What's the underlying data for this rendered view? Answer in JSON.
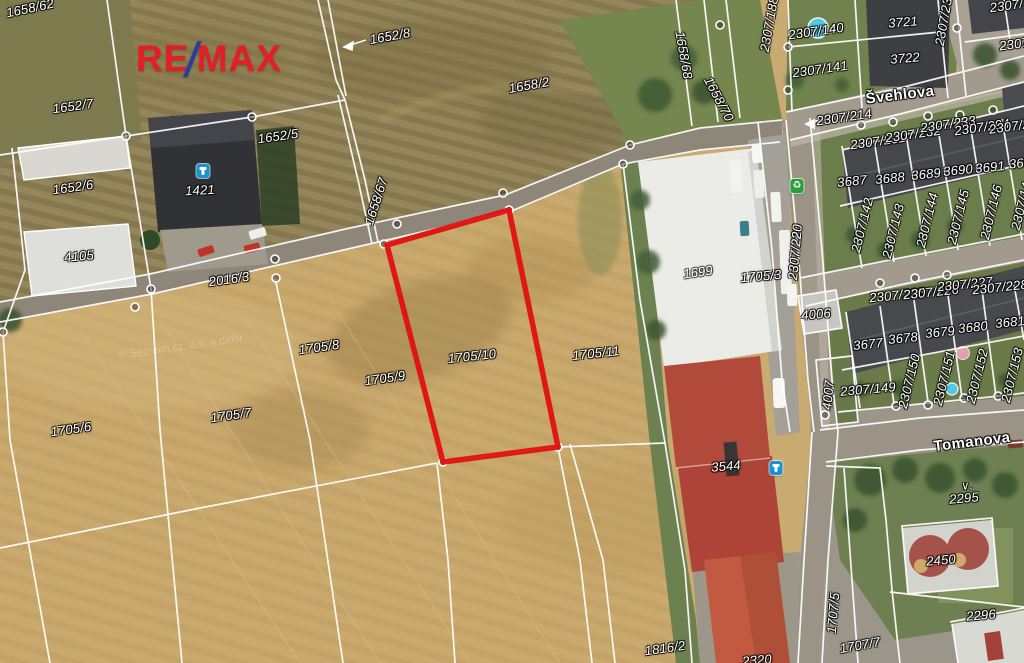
{
  "branding": {
    "re": "RE",
    "slash": "/",
    "max": "MAX"
  },
  "watermark": "© Seznam.cz, a.s. a další",
  "highlighted_parcel": {
    "id": "1705/10",
    "outline_color": "#e11212",
    "points": "387,245 509,210 558,447 443,462"
  },
  "streets": [
    {
      "name": "Švehlova"
    },
    {
      "name": "Tomanova"
    }
  ],
  "labels": [
    {
      "text": "1658/62",
      "x": 30,
      "y": 8,
      "rot": -12,
      "kind": "parcel"
    },
    {
      "text": "1652/8",
      "x": 390,
      "y": 36,
      "rot": -10,
      "kind": "parcel"
    },
    {
      "text": "1658/2",
      "x": 529,
      "y": 85,
      "rot": -10,
      "kind": "parcel"
    },
    {
      "text": "1652/7",
      "x": 73,
      "y": 106,
      "rot": -8,
      "kind": "parcel"
    },
    {
      "text": "1652/5",
      "x": 278,
      "y": 136,
      "rot": -8,
      "kind": "parcel"
    },
    {
      "text": "1652/6",
      "x": 73,
      "y": 187,
      "rot": -8,
      "kind": "parcel"
    },
    {
      "text": "1421",
      "x": 200,
      "y": 190,
      "rot": -3,
      "kind": "building"
    },
    {
      "text": "4105",
      "x": 79,
      "y": 256,
      "rot": -5,
      "kind": "building"
    },
    {
      "text": "2016/3",
      "x": 229,
      "y": 279,
      "rot": -8,
      "kind": "parcel"
    },
    {
      "text": "1705/8",
      "x": 319,
      "y": 347,
      "rot": -8,
      "kind": "parcel"
    },
    {
      "text": "1705/9",
      "x": 385,
      "y": 378,
      "rot": -8,
      "kind": "parcel"
    },
    {
      "text": "1705/10",
      "x": 472,
      "y": 356,
      "rot": -6,
      "kind": "parcel"
    },
    {
      "text": "1705/11",
      "x": 596,
      "y": 353,
      "rot": -6,
      "kind": "parcel"
    },
    {
      "text": "1705/7",
      "x": 231,
      "y": 415,
      "rot": -8,
      "kind": "parcel"
    },
    {
      "text": "1705/6",
      "x": 71,
      "y": 429,
      "rot": -8,
      "kind": "parcel"
    },
    {
      "text": "1699",
      "x": 698,
      "y": 272,
      "rot": -8,
      "kind": "faint"
    },
    {
      "text": "1705/3",
      "x": 761,
      "y": 276,
      "rot": -5,
      "kind": "parcel"
    },
    {
      "text": "4006",
      "x": 816,
      "y": 314,
      "rot": -5,
      "kind": "building"
    },
    {
      "text": "3544",
      "x": 726,
      "y": 466,
      "rot": -5,
      "kind": "building"
    },
    {
      "text": "Tomanova",
      "x": 972,
      "y": 442,
      "rot": -7,
      "kind": "street"
    },
    {
      "text": "2295",
      "x": 964,
      "y": 498,
      "rot": -5,
      "kind": "parcel"
    },
    {
      "text": "∨.",
      "x": 967,
      "y": 487,
      "rot": 0,
      "kind": "symbol"
    },
    {
      "text": "2450",
      "x": 941,
      "y": 560,
      "rot": -5,
      "kind": "building"
    },
    {
      "text": "2296",
      "x": 981,
      "y": 615,
      "rot": -5,
      "kind": "parcel"
    },
    {
      "text": "1707/7",
      "x": 860,
      "y": 645,
      "rot": -10,
      "kind": "parcel"
    },
    {
      "text": "1816/2",
      "x": 665,
      "y": 648,
      "rot": -8,
      "kind": "parcel"
    },
    {
      "text": "Švehlova",
      "x": 900,
      "y": 95,
      "rot": -7,
      "kind": "street"
    },
    {
      "text": "2307/214",
      "x": 844,
      "y": 117,
      "rot": -8,
      "kind": "parcel"
    },
    {
      "text": "2307/140",
      "x": 816,
      "y": 31,
      "rot": -8,
      "kind": "parcel"
    },
    {
      "text": "3721",
      "x": 903,
      "y": 22,
      "rot": -5,
      "kind": "building"
    },
    {
      "text": "3722",
      "x": 905,
      "y": 58,
      "rot": -5,
      "kind": "building"
    },
    {
      "text": "2307/141",
      "x": 820,
      "y": 69,
      "rot": -8,
      "kind": "parcel"
    },
    {
      "text": "2307/188",
      "x": 769,
      "y": 24,
      "rot": -80,
      "kind": "parcel"
    },
    {
      "text": "2307/238",
      "x": 944,
      "y": 18,
      "rot": -80,
      "kind": "parcel"
    },
    {
      "text": "2307/231",
      "x": 878,
      "y": 141,
      "rot": -8,
      "kind": "parcel"
    },
    {
      "text": "2307/232",
      "x": 913,
      "y": 134,
      "rot": -8,
      "kind": "parcel"
    },
    {
      "text": "2307/233",
      "x": 948,
      "y": 124,
      "rot": -8,
      "kind": "parcel"
    },
    {
      "text": "2307/294",
      "x": 982,
      "y": 127,
      "rot": -8,
      "kind": "parcel"
    },
    {
      "text": "2307/29",
      "x": 1013,
      "y": 126,
      "rot": -8,
      "kind": "parcel"
    },
    {
      "text": "3687",
      "x": 852,
      "y": 181,
      "rot": -6,
      "kind": "building"
    },
    {
      "text": "3688",
      "x": 890,
      "y": 178,
      "rot": -6,
      "kind": "building"
    },
    {
      "text": "3689",
      "x": 926,
      "y": 174,
      "rot": -6,
      "kind": "building"
    },
    {
      "text": "3690",
      "x": 958,
      "y": 170,
      "rot": -6,
      "kind": "building"
    },
    {
      "text": "3691",
      "x": 990,
      "y": 167,
      "rot": -6,
      "kind": "building"
    },
    {
      "text": "369",
      "x": 1020,
      "y": 163,
      "rot": -6,
      "kind": "building"
    },
    {
      "text": "2307/142",
      "x": 862,
      "y": 225,
      "rot": -76,
      "kind": "parcel"
    },
    {
      "text": "2307/143",
      "x": 893,
      "y": 231,
      "rot": -76,
      "kind": "parcel"
    },
    {
      "text": "2307/144",
      "x": 927,
      "y": 220,
      "rot": -76,
      "kind": "parcel"
    },
    {
      "text": "2307/145",
      "x": 958,
      "y": 217,
      "rot": -76,
      "kind": "parcel"
    },
    {
      "text": "2307/146",
      "x": 991,
      "y": 212,
      "rot": -76,
      "kind": "parcel"
    },
    {
      "text": "2307/14",
      "x": 1021,
      "y": 206,
      "rot": -76,
      "kind": "parcel"
    },
    {
      "text": "2307/225",
      "x": 897,
      "y": 295,
      "rot": -6,
      "kind": "parcel"
    },
    {
      "text": "2307/226",
      "x": 931,
      "y": 292,
      "rot": -6,
      "kind": "parcel"
    },
    {
      "text": "2307/227",
      "x": 965,
      "y": 284,
      "rot": -6,
      "kind": "parcel"
    },
    {
      "text": "2307/228",
      "x": 1000,
      "y": 287,
      "rot": -6,
      "kind": "parcel"
    },
    {
      "text": "3677",
      "x": 868,
      "y": 344,
      "rot": -6,
      "kind": "building"
    },
    {
      "text": "3678",
      "x": 903,
      "y": 338,
      "rot": -6,
      "kind": "building"
    },
    {
      "text": "3679",
      "x": 940,
      "y": 332,
      "rot": -6,
      "kind": "building"
    },
    {
      "text": "3680",
      "x": 973,
      "y": 327,
      "rot": -6,
      "kind": "building"
    },
    {
      "text": "3681",
      "x": 1010,
      "y": 322,
      "rot": -6,
      "kind": "building"
    },
    {
      "text": "2307/149",
      "x": 868,
      "y": 389,
      "rot": -5,
      "kind": "parcel"
    },
    {
      "text": "2307/150",
      "x": 909,
      "y": 381,
      "rot": -76,
      "kind": "parcel"
    },
    {
      "text": "2307/151",
      "x": 944,
      "y": 378,
      "rot": -76,
      "kind": "parcel"
    },
    {
      "text": "2307/152",
      "x": 977,
      "y": 376,
      "rot": -76,
      "kind": "parcel"
    },
    {
      "text": "2307/153",
      "x": 1012,
      "y": 375,
      "rot": -76,
      "kind": "parcel"
    },
    {
      "text": "4007",
      "x": 828,
      "y": 395,
      "rot": -85,
      "kind": "parcel"
    },
    {
      "text": "2307/220",
      "x": 795,
      "y": 252,
      "rot": -85,
      "kind": "parcel"
    },
    {
      "text": "1707/5",
      "x": 833,
      "y": 613,
      "rot": -85,
      "kind": "parcel"
    },
    {
      "text": "1658/67",
      "x": 376,
      "y": 201,
      "rot": -72,
      "kind": "parcel"
    },
    {
      "text": "1658/68",
      "x": 684,
      "y": 55,
      "rot": 80,
      "kind": "parcel"
    },
    {
      "text": "1658/70",
      "x": 719,
      "y": 99,
      "rot": 62,
      "kind": "parcel"
    },
    {
      "text": "2320",
      "x": 757,
      "y": 660,
      "rot": -5,
      "kind": "parcel"
    },
    {
      "text": "2307/1",
      "x": 1010,
      "y": 5,
      "rot": -8,
      "kind": "parcel"
    },
    {
      "text": "2307",
      "x": 1014,
      "y": 44,
      "rot": -8,
      "kind": "parcel"
    }
  ],
  "icons": [
    {
      "type": "hydrant",
      "name": "hydrant-icon",
      "x": 203,
      "y": 171
    },
    {
      "type": "hydrant",
      "name": "hydrant-icon",
      "x": 776,
      "y": 468
    },
    {
      "type": "recycle",
      "name": "recycling-icon",
      "x": 797,
      "y": 186,
      "glyph": "♻"
    }
  ]
}
